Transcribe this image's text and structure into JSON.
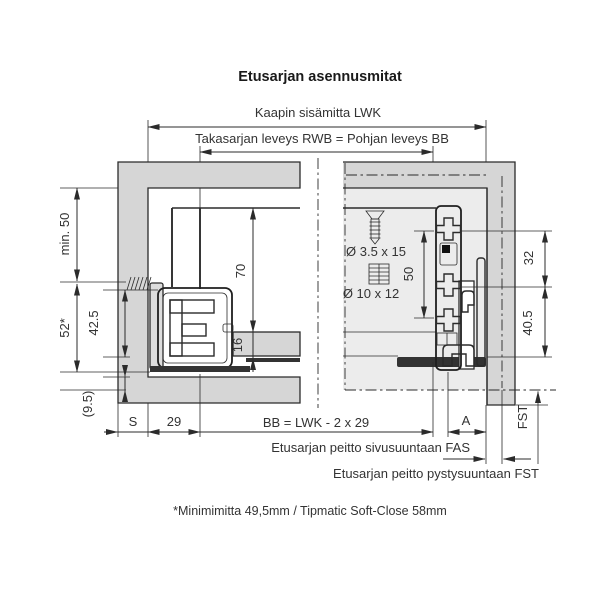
{
  "title": "Etusarjan asennusmitat",
  "footnote": "*Minimimitta 49,5mm / Tipmatic Soft-Close 58mm",
  "dims": {
    "cabinet_inner_width": "Kaapin sisämitta LWK",
    "back_width": "Takasarjan leveys RWB = Pohjan leveys BB",
    "min_height": "min. 50",
    "height_52": "52*",
    "height_42_5": "42.5",
    "height_9_5": "(9.5)",
    "height_70": "70",
    "height_16": "16",
    "screw_size": "Ø 3.5 x 15",
    "dowel_size": "Ø 10 x 12",
    "height_50": "50",
    "height_32": "32",
    "height_40_5": "40.5",
    "gap_s": "S",
    "width_29": "29",
    "bottom_formula": "BB = LWK - 2 x 29",
    "overlay_a": "A",
    "fst": "FST",
    "note_fas": "Etusarjan peitto sivusuuntaan FAS",
    "note_fst": "Etusarjan peitto pystysuuntaan FST"
  },
  "colors": {
    "panel_gray": "#d6d6d6",
    "front_panel_light": "#ececec",
    "bracket_fill": "#fafafa",
    "line": "#2b2b2b",
    "dark_part": "#333333"
  }
}
